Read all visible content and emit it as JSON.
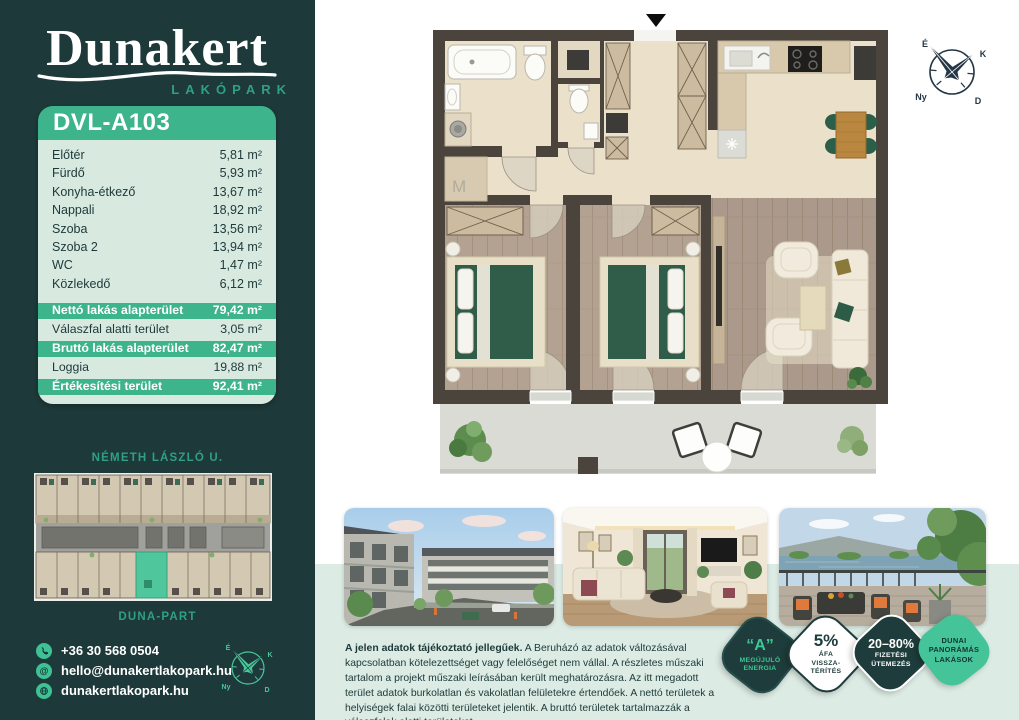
{
  "brand": {
    "name": "Dunakert",
    "subtitle": "LAKÓPARK"
  },
  "unit": {
    "id": "DVL-A103",
    "rooms": [
      {
        "label": "Előtér",
        "value": "5,81 m²"
      },
      {
        "label": "Fürdő",
        "value": "5,93 m²"
      },
      {
        "label": "Konyha-étkező",
        "value": "13,67 m²"
      },
      {
        "label": "Nappali",
        "value": "18,92 m²"
      },
      {
        "label": "Szoba",
        "value": "13,56 m²"
      },
      {
        "label": "Szoba 2",
        "value": "13,94 m²"
      },
      {
        "label": "WC",
        "value": "1,47 m²"
      },
      {
        "label": "Közlekedő",
        "value": "6,12 m²"
      }
    ],
    "summary": [
      {
        "label": "Nettó lakás alapterület",
        "value": "79,42 m²",
        "highlight": true
      },
      {
        "label": "Válaszfal alatti terület",
        "value": "3,05 m²",
        "highlight": false
      },
      {
        "label": "Bruttó lakás alapterület",
        "value": "82,47 m²",
        "highlight": true
      },
      {
        "label": "Loggia",
        "value": "19,88 m²",
        "highlight": false
      },
      {
        "label": "Értékesítési terület",
        "value": "92,41 m²",
        "highlight": true
      }
    ]
  },
  "siteplan": {
    "street_top": "NÉMETH LÁSZLÓ U.",
    "street_bottom": "DUNA-PART"
  },
  "contact": {
    "items": [
      {
        "icon": "phone-icon",
        "text": "+36 30 568 0504"
      },
      {
        "icon": "at-icon",
        "text": "hello@dunakertlakopark.hu"
      },
      {
        "icon": "globe-icon",
        "text": "dunakertlakopark.hu"
      }
    ]
  },
  "floorplan": {
    "washer_label": "M"
  },
  "compass": {
    "north": "É",
    "east": "K",
    "south": "D",
    "west": "Ny"
  },
  "disclaimer": {
    "bold": "A jelen adatok tájékoztató jellegűek.",
    "text": " A Beruházó az adatok változásával kapcsolatban kötelezettséget vagy felelőséget nem vállal. A részletes műszaki tartalom a projekt műszaki leírásában került meghatározásra. Az itt megadott terület adatok burkolatlan és vakolatlan felületekre értendőek. A nettó területek a helyiségek falai közötti területeket jelentik. A bruttó területek tartalmazzák a válaszfalak alatti területeket."
  },
  "badges": [
    {
      "big": "“A”",
      "lines": [
        "MEGÚJULÓ",
        "ENERGIA"
      ]
    },
    {
      "big": "5%",
      "lines": [
        "ÁFA",
        "VISSZA-",
        "TÉRÍTÉS"
      ]
    },
    {
      "big": "20–80%",
      "lines": [
        "FIZETÉSI",
        "ÜTEMEZÉS"
      ]
    },
    {
      "big": "",
      "lines": [
        "DUNAI",
        "PANORÁMÁS",
        "LAKÁSOK"
      ]
    }
  ],
  "colors": {
    "sidebar_dark_teal": "#1d3939",
    "accent_green": "#3eb48c",
    "card_mint": "#d8e9e0",
    "band_mint": "#dcebe4",
    "badge_green": "#45c49a",
    "logo_sub_green": "#2fa083"
  }
}
